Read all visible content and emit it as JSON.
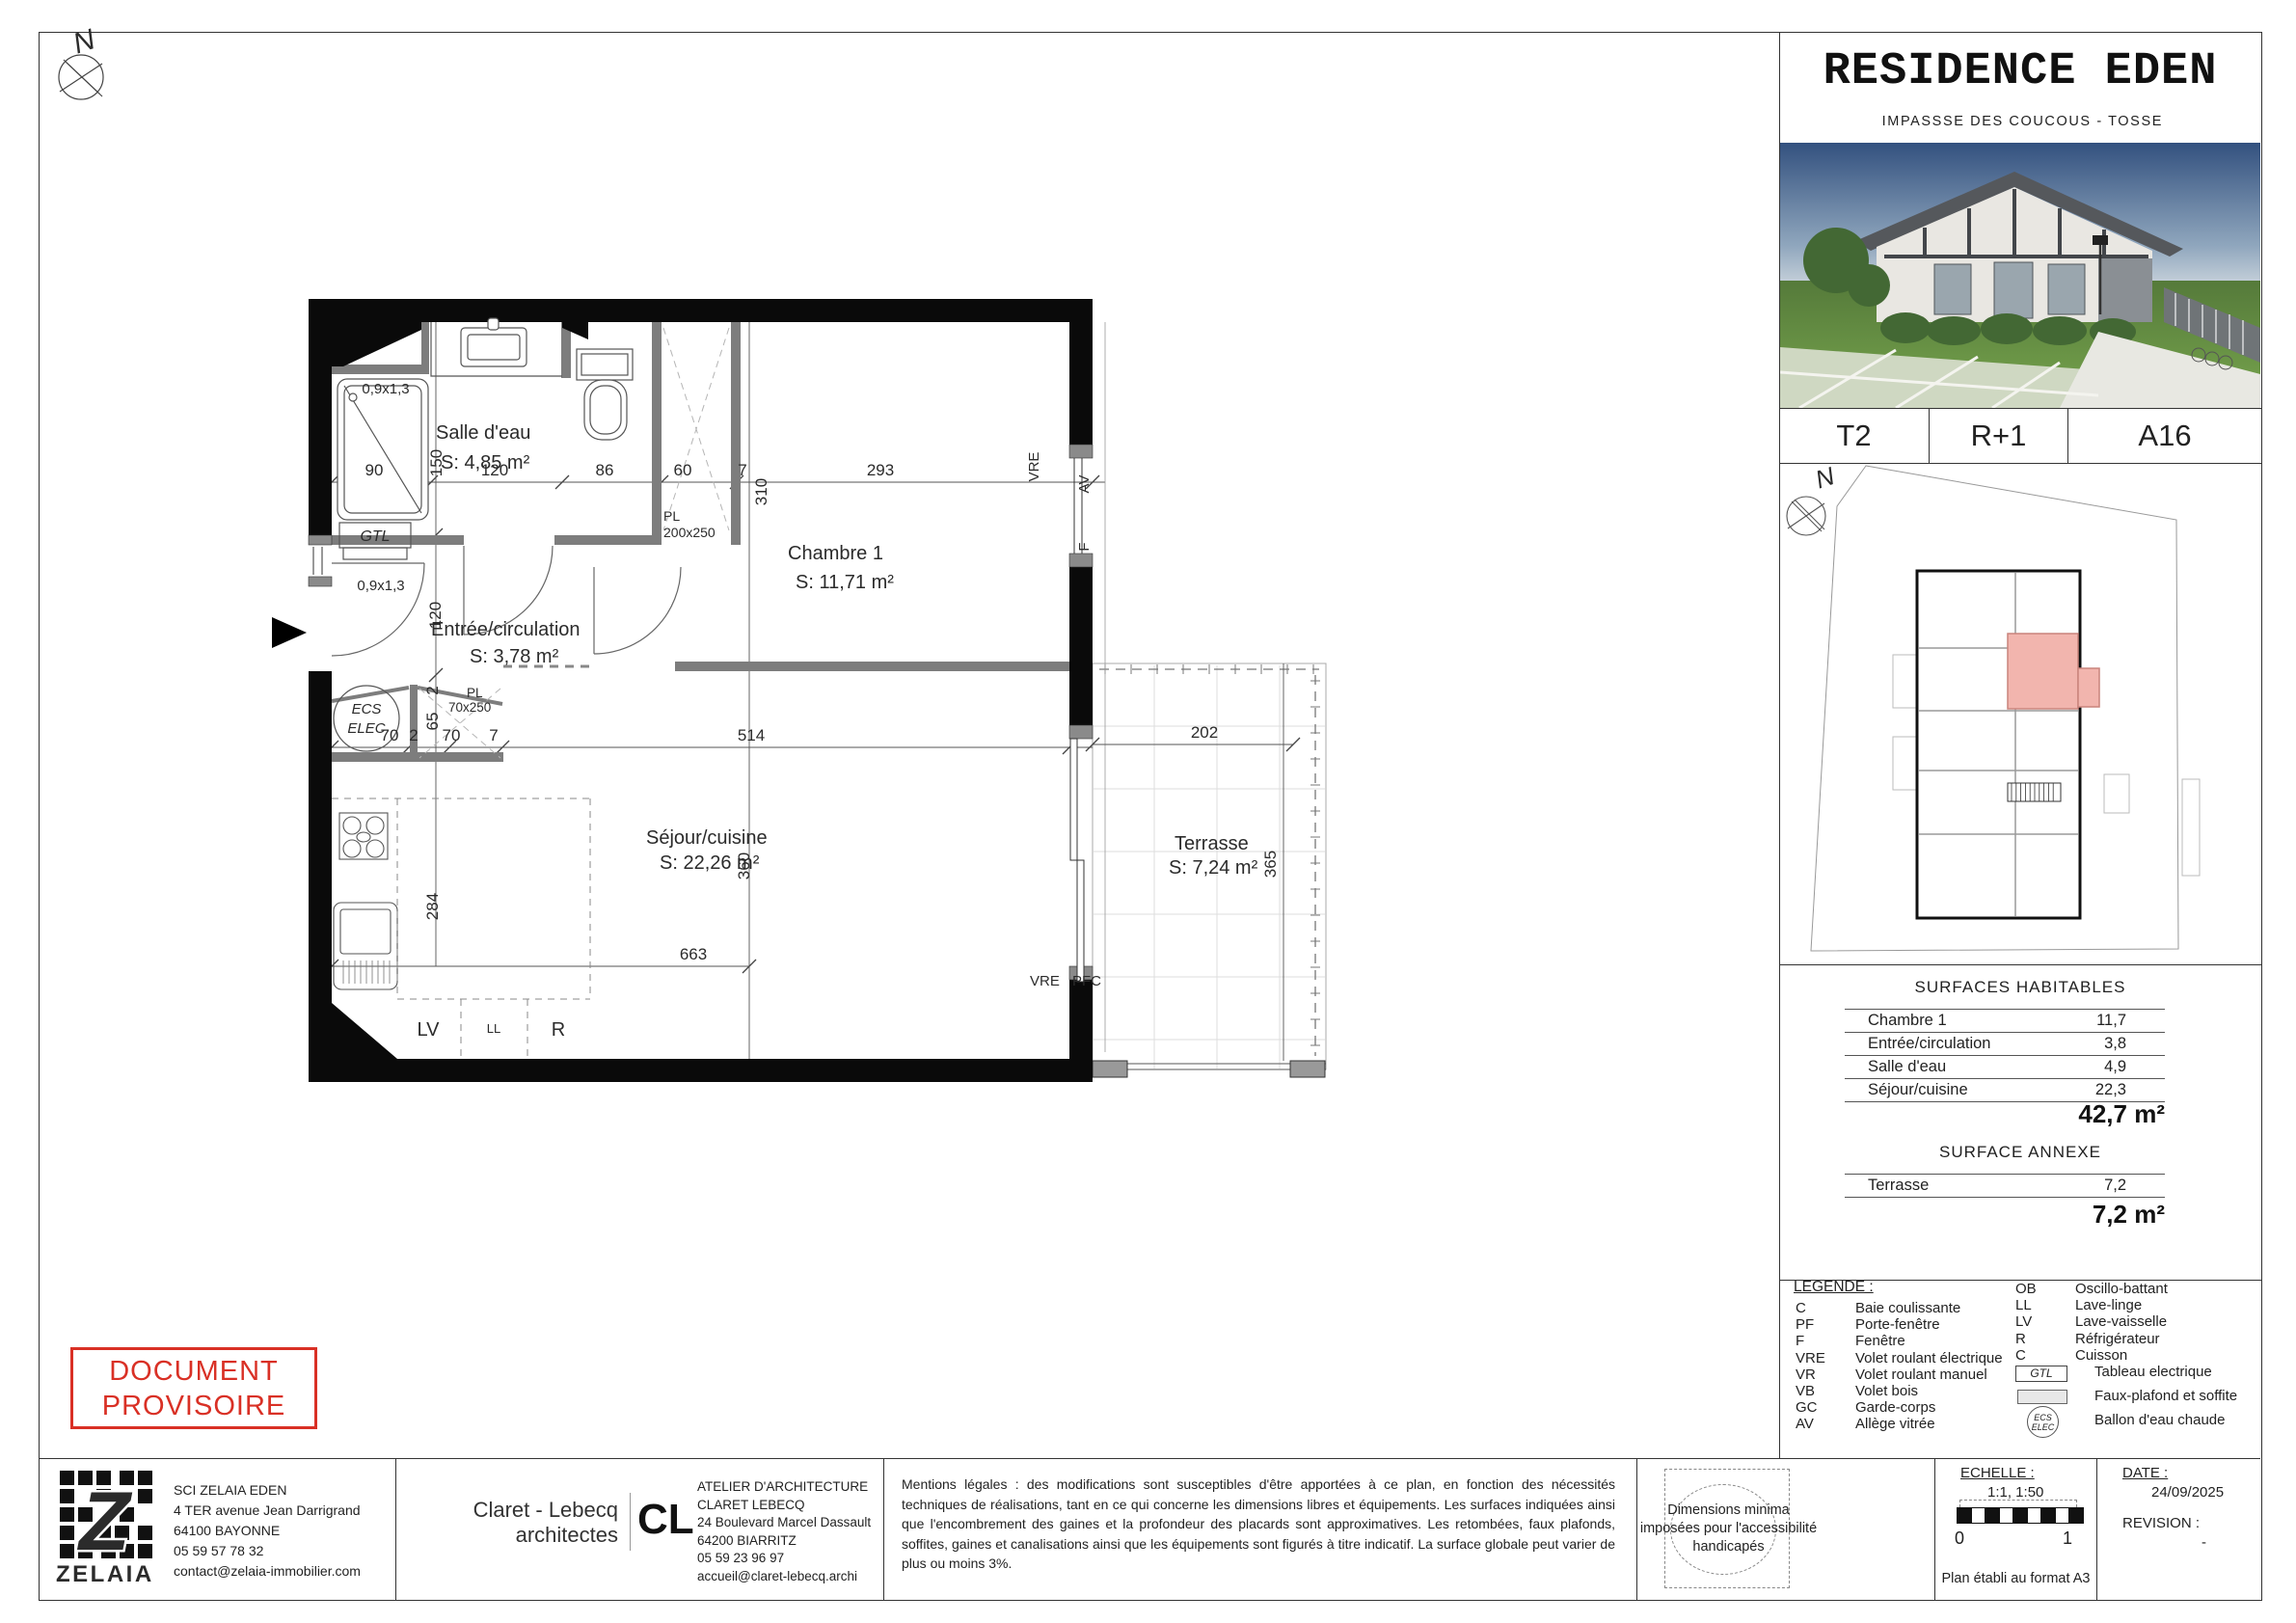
{
  "sheet": {
    "title": "RESIDENCE EDEN",
    "subtitle": "IMPASSSE DES COUCOUS - TOSSE",
    "unit_type": "T2",
    "floor": "R+1",
    "unit_id": "A16",
    "north": "N"
  },
  "plan": {
    "rooms": {
      "salle_deau": {
        "name": "Salle d'eau",
        "area": "S: 4,85 m²"
      },
      "chambre": {
        "name": "Chambre 1",
        "area": "S: 11,71 m²"
      },
      "entree": {
        "name": "Entrée/circulation",
        "area": "S: 3,78 m²"
      },
      "sejour": {
        "name": "Séjour/cuisine",
        "area": "S: 22,26 m²"
      },
      "terrasse": {
        "name": "Terrasse",
        "area": "S: 7,24 m²"
      }
    },
    "dims": {
      "d90": "90",
      "d150": "150",
      "d120": "120",
      "d86": "86",
      "d60": "60",
      "d7a": "7",
      "d293": "293",
      "d310": "310",
      "d120v": "120",
      "d2v": "2",
      "d65": "65",
      "d70a": "70",
      "d2b": "2",
      "d70b": "70",
      "d7b": "7",
      "d514": "514",
      "d360": "360",
      "d284": "284",
      "d663": "663",
      "d202": "202",
      "d365": "365",
      "w1": "0,9x1,3",
      "w2": "0,9x1,3"
    },
    "labels": {
      "gtl": "GTL",
      "ecs1": "ECS",
      "ecs2": "ELEC",
      "pl200a": "PL",
      "pl200b": "200x250",
      "pl70a": "PL",
      "pl70b": "70x250",
      "vre_top": "VRE",
      "av": "AV",
      "f": "F",
      "vre_bottom": "VRE",
      "pfc": "PFC",
      "lv": "LV",
      "ll": "LL",
      "r": "R"
    }
  },
  "surfaces": {
    "title": "SURFACES HABITABLES",
    "rows": [
      {
        "name": "Chambre 1",
        "value": "11,7"
      },
      {
        "name": "Entrée/circulation",
        "value": "3,8"
      },
      {
        "name": "Salle d'eau",
        "value": "4,9"
      },
      {
        "name": "Séjour/cuisine",
        "value": "22,3"
      }
    ],
    "total": "42,7 m²",
    "annex_title": "SURFACE ANNEXE",
    "annex_rows": [
      {
        "name": "Terrasse",
        "value": "7,2"
      }
    ],
    "annex_total": "7,2 m²"
  },
  "legend": {
    "title": "LEGENDE :",
    "left": [
      {
        "code": "C",
        "label": "Baie coulissante"
      },
      {
        "code": "PF",
        "label": "Porte-fenêtre"
      },
      {
        "code": "F",
        "label": "Fenêtre"
      },
      {
        "code": "VRE",
        "label": "Volet roulant électrique"
      },
      {
        "code": "VR",
        "label": "Volet roulant manuel"
      },
      {
        "code": "VB",
        "label": "Volet bois"
      },
      {
        "code": "GC",
        "label": "Garde-corps"
      },
      {
        "code": "AV",
        "label": "Allège vitrée"
      }
    ],
    "right": [
      {
        "code": "OB",
        "label": "Oscillo-battant"
      },
      {
        "code": "LL",
        "label": "Lave-linge"
      },
      {
        "code": "LV",
        "label": "Lave-vaisselle"
      },
      {
        "code": "R",
        "label": "Réfrigérateur"
      },
      {
        "code": "C",
        "label": "Cuisson"
      }
    ],
    "gtl_symbol": "GTL",
    "gtl_label": "Tableau electrique",
    "faux_plafond_label": "Faux-plafond et soffite",
    "ecs_line1": "ECS",
    "ecs_line2": "ELEC",
    "ecs_label": "Ballon d'eau chaude"
  },
  "stamp": {
    "line1": "DOCUMENT",
    "line2": "PROVISOIRE"
  },
  "footer": {
    "owner": {
      "logo_text": "ZELAIA",
      "logo_letter": "Z",
      "line1": "SCI ZELAIA EDEN",
      "line2": "4 TER avenue Jean Darrigrand 64100 BAYONNE",
      "line3": "05 59 57 78 32",
      "line4": "contact@zelaia-immobilier.com"
    },
    "architect": {
      "wordmark1": "Claret - Lebecq",
      "wordmark2": "architectes",
      "monogram": "CL",
      "line1": "ATELIER D'ARCHITECTURE CLARET LEBECQ",
      "line2": "24 Boulevard Marcel Dassault",
      "line3": "64200 BIARRITZ",
      "line4": "05 59 23 96 97",
      "line5": "accueil@claret-lebecq.archi"
    },
    "legal": "Mentions légales : des modifications sont susceptibles d'être apportées à ce plan, en fonction des nécessités techniques de réalisations, tant en ce qui concerne les dimensions libres et équipements. Les surfaces indiquées ainsi que l'encombrement des gaines et la profondeur des placards sont approximatives. Les retombées, faux plafonds, soffites, gaines et canalisations ainsi que les équipements sont figurés à titre indicatif. La surface globale peut varier de plus ou moins 3%.",
    "accessibility": "Dimensions minima imposées pour l'accessibilité handicapés",
    "scale": {
      "title": "ECHELLE :",
      "value": "1:1, 1:50",
      "zero": "0",
      "one": "1",
      "format_note": "Plan établi au format A3"
    },
    "date": {
      "title": "DATE :",
      "value": "24/09/2025",
      "revision_title": "REVISION :",
      "revision_value": "-"
    }
  },
  "colors": {
    "wall": "#0a0a0a",
    "interior_wall": "#7d7d7d",
    "highlight_unit": "#f2b5ae",
    "highlight_border": "#c9837c",
    "stamp_red": "#d93025",
    "brand_blue": "#2d4a86"
  }
}
